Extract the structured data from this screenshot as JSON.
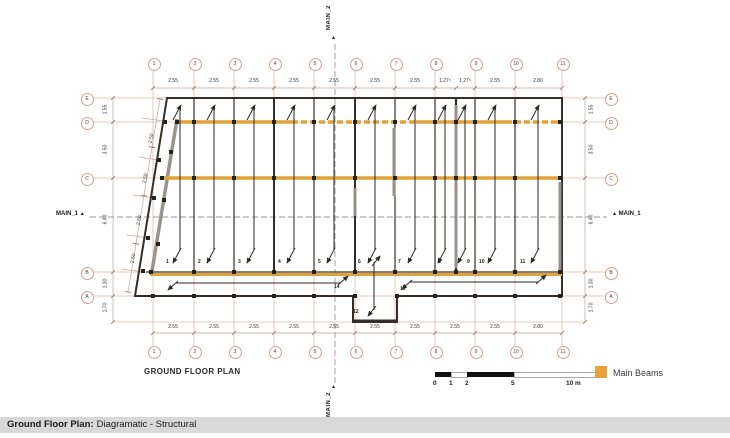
{
  "drawing": {
    "title": "GROUND FLOOR PLAN",
    "grid_columns": [
      "1",
      "2",
      "3",
      "4",
      "5",
      "6",
      "7",
      "8",
      "9",
      "10",
      "11"
    ],
    "grid_rows": [
      "E",
      "D",
      "C",
      "B",
      "A"
    ],
    "dimensions": {
      "top": [
        "2.55",
        "2.55",
        "2.55",
        "2.55",
        "2.55",
        "2.55",
        "2.55",
        "1.27⁵",
        "1.27⁵",
        "2.55",
        "2.80"
      ],
      "bottom": [
        "2.55",
        "2.55",
        "2.55",
        "2.55",
        "2.55",
        "2.55",
        "2.55",
        "2.55",
        "2.55",
        "2.80"
      ],
      "left": [
        "1.55",
        "3.50",
        "6.40",
        "1.30",
        "1.70"
      ],
      "right": [
        "1.55",
        "3.50",
        "6.40",
        "1.30",
        "1.70"
      ],
      "slant": [
        "2.50",
        "2.50",
        "2.50",
        "2.50"
      ]
    },
    "slab_numbers": [
      "1",
      "2",
      "3",
      "4",
      "5",
      "6",
      "7",
      "8",
      "9",
      "10",
      "11",
      "12",
      "13",
      "14"
    ],
    "section_markers": {
      "main1": "MAIN_1",
      "main2": "MAIN_2",
      "triangle": "▲"
    }
  },
  "scale_bar": {
    "labels": [
      "0",
      "1",
      "2",
      "5",
      "10 m"
    ]
  },
  "legend": {
    "main_beams_label": "Main Beams",
    "main_beams_color": "#E8A33C"
  },
  "status_bar": {
    "bold": "Ground Floor Plan:",
    "text": "Diagramatic - Structural"
  },
  "colors": {
    "beam_orange": "#E2A23B",
    "wall_dark": "#332E29",
    "grid_faint": "#D9BCAC",
    "gray_wall": "#97908A",
    "statusbar_bg": "#D8D8D8"
  }
}
